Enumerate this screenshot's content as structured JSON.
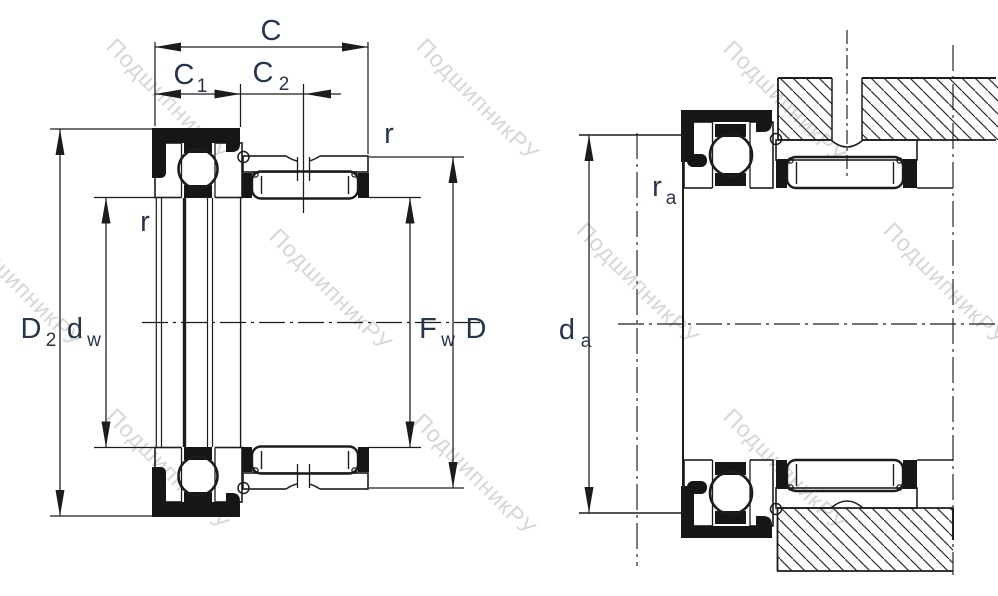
{
  "watermark": {
    "text": "ПодшипникРУ"
  },
  "colors": {
    "line": "#1c1c1c",
    "black_fill": "#161616",
    "label": "#26354a",
    "watermark": "#b5b5b5",
    "background": "#ffffff"
  },
  "views": {
    "left": {
      "description": "bearing cross-section with boundary dimensions",
      "labels": {
        "C": {
          "base": "C"
        },
        "C1": {
          "base": "C",
          "sub": "1"
        },
        "C2": {
          "base": "C",
          "sub": "2"
        },
        "r_outer": {
          "base": "r"
        },
        "r_inner": {
          "base": "r"
        },
        "D2": {
          "base": "D",
          "sub": "2"
        },
        "dw": {
          "base": "d",
          "sub": "w"
        },
        "Fw": {
          "base": "F",
          "sub": "w"
        },
        "D": {
          "base": "D"
        }
      }
    },
    "right": {
      "description": "bearing mounted in housing with abutment dimensions",
      "labels": {
        "da": {
          "base": "d",
          "sub": "a"
        },
        "ra": {
          "base": "r",
          "sub": "a"
        }
      }
    }
  }
}
